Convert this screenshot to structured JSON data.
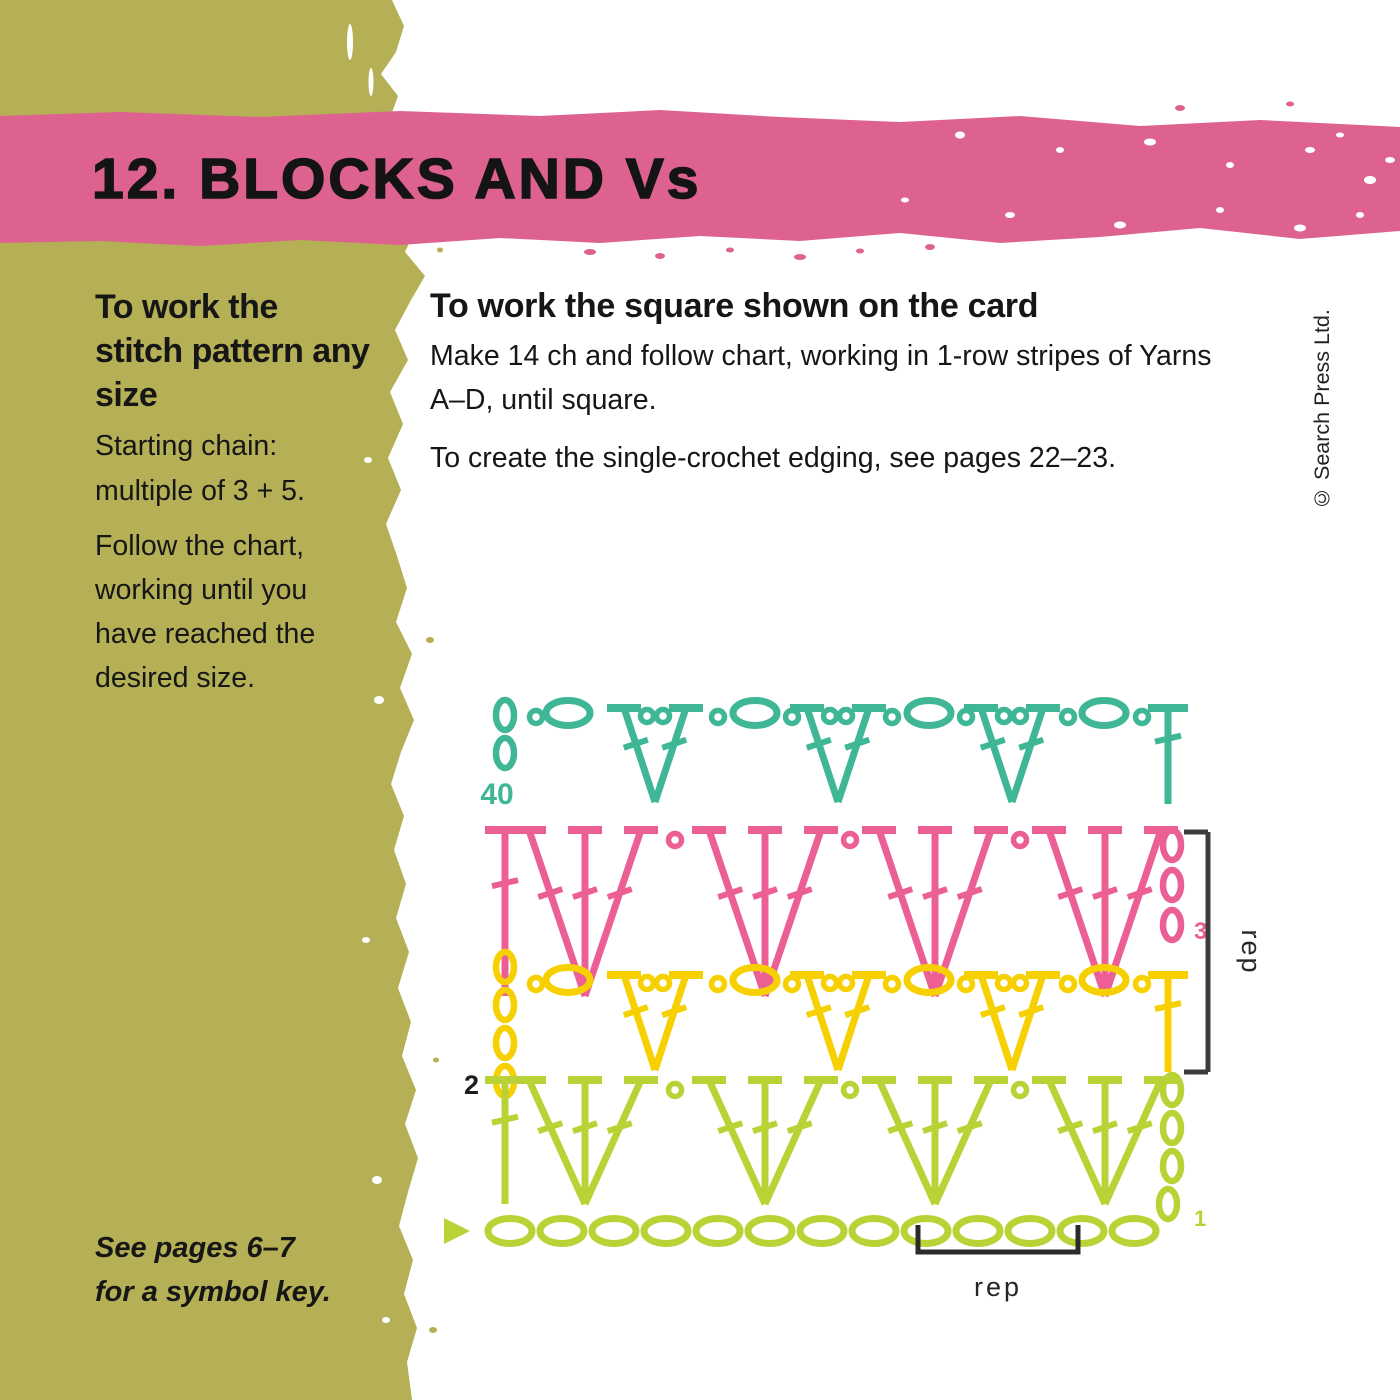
{
  "banner": {
    "title": "12. BLOCKS AND Vs",
    "background_color": "#de6290"
  },
  "page_colors": {
    "olive_brush": "#b5af55",
    "banner_pink": "#de6290",
    "text_black": "#161616"
  },
  "left_column": {
    "heading": "To work the stitch pattern any size",
    "para1": "Starting chain: multiple of 3 + 5.",
    "para2": "Follow the chart, working until you have reached the desired size.",
    "footnote_line1": "See pages 6–7",
    "footnote_line2": "for a symbol key."
  },
  "right_column": {
    "heading": "To work the square shown on the card",
    "para1": "Make 14 ch and follow chart, working in 1-row stripes of Yarns A–D, until square.",
    "para2": "To create the single-crochet edging, see pages 22–23."
  },
  "copyright": "© Search Press Ltd.",
  "chart_data": {
    "type": "crochet-symbol-chart",
    "title": "Blocks and Vs stitch chart",
    "yarn_colors": {
      "teal": "#3fb796",
      "pink": "#ec5f95",
      "yellow": "#f6d000",
      "lime": "#b9d337"
    },
    "rows": [
      {
        "number": "40",
        "yarn": "teal",
        "kind": "v",
        "number_color": "#3fb796",
        "number_side": "left",
        "turning_chain_ovals": 3,
        "v_stitches": 3,
        "chain_ovals_between": 4,
        "end_stitch": "dc"
      },
      {
        "number": "3",
        "yarn": "pink",
        "kind": "shell",
        "number_color": "#ec5f95",
        "number_side": "right",
        "turning_chain_ovals": 3,
        "shells": 4,
        "start_stitch": "dc"
      },
      {
        "number": "2",
        "yarn": "yellow",
        "kind": "v",
        "number_color": "#1d1d1d",
        "number_side": "left",
        "turning_chain_ovals": 4,
        "v_stitches": 3,
        "chain_ovals_between": 4,
        "end_stitch": "dc"
      },
      {
        "number": "1",
        "yarn": "lime",
        "kind": "shell",
        "number_color": "#b9d337",
        "number_side": "right",
        "turning_chain_ovals": 4,
        "shells": 4,
        "start_stitch": "dc"
      }
    ],
    "foundation": {
      "yarn": "lime",
      "chain_count": 13,
      "start_marker": "triangle"
    },
    "repeats": {
      "vertical_label": "rep",
      "horizontal_label": "rep",
      "bracket_color": "#3c3c3c",
      "vertical_covers_rows": [
        "3",
        "2"
      ],
      "horizontal_covers_chains": 3
    }
  }
}
